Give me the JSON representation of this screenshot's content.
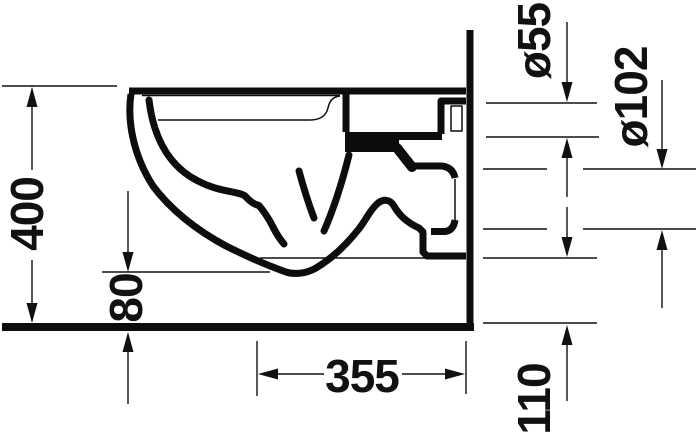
{
  "figure": {
    "background": "#ffffff",
    "line_color": "#111111"
  },
  "dimensions": {
    "overall_height": {
      "label": "400"
    },
    "bowl_underside_height": {
      "label": "80"
    },
    "depth": {
      "label": "355"
    },
    "outlet_bottom_height": {
      "label": "110"
    },
    "flush_inlet_diameter": {
      "label": "ø55"
    },
    "drain_outlet_diameter": {
      "label": "ø102"
    }
  }
}
